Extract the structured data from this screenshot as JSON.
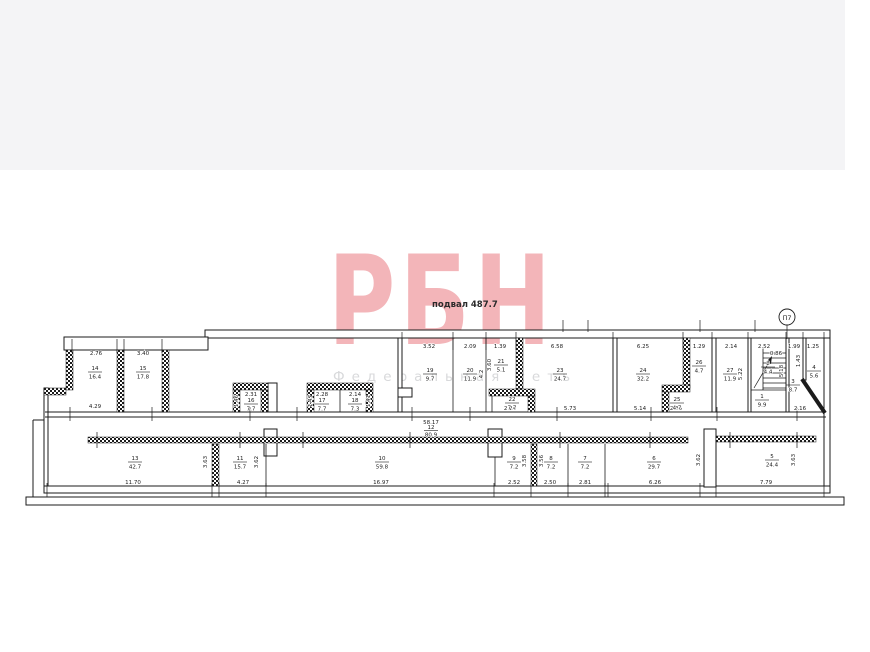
{
  "page": {
    "band_color": "#f4f4f6"
  },
  "watermark": {
    "brand": "РБН",
    "subtitle": "Федеральная сеть",
    "brand_color": "#e24650"
  },
  "plan": {
    "title": "подвал 487.7",
    "section_marker": "П7",
    "rooms": [
      {
        "num": "14",
        "area": "16.4"
      },
      {
        "num": "15",
        "area": "17.8"
      },
      {
        "num": "16",
        "area": "7.7"
      },
      {
        "num": "17",
        "area": "7.7"
      },
      {
        "num": "18",
        "area": "7.3"
      },
      {
        "num": "19",
        "area": "9.7"
      },
      {
        "num": "20",
        "area": "11.9"
      },
      {
        "num": "21",
        "area": "5.1"
      },
      {
        "num": "22",
        "area": "7.7"
      },
      {
        "num": "23",
        "area": "24.7"
      },
      {
        "num": "24",
        "area": "32.2"
      },
      {
        "num": "26",
        "area": "4.7"
      },
      {
        "num": "25",
        "area": "4.7"
      },
      {
        "num": "27",
        "area": "11.9"
      },
      {
        "num": "2",
        "area": "4.4"
      },
      {
        "num": "1",
        "area": "9.9"
      },
      {
        "num": "3",
        "area": "8.7"
      },
      {
        "num": "4",
        "area": "5.6"
      },
      {
        "num": "12",
        "area": "80.9"
      },
      {
        "num": "13",
        "area": "42.7"
      },
      {
        "num": "11",
        "area": "15.7"
      },
      {
        "num": "10",
        "area": "59.8"
      },
      {
        "num": "9",
        "area": "7.2"
      },
      {
        "num": "8",
        "area": "7.2"
      },
      {
        "num": "7",
        "area": "7.2"
      },
      {
        "num": "6",
        "area": "29.7"
      },
      {
        "num": "5",
        "area": "24.4"
      }
    ],
    "dims": [
      "2.76",
      "3.40",
      "4.29",
      "2.31",
      "2.28",
      "2.14",
      "3.52",
      "2.09",
      "1.39",
      "6.58",
      "2.24",
      "5.73",
      "6.25",
      "1.29",
      "2.35",
      "5.14",
      "2.14",
      "2.52",
      "0.86",
      "1.99",
      "1.25",
      "2.16",
      "58.17",
      "11.70",
      "4.27",
      "16.97",
      "2.52",
      "2.50",
      "2.81",
      "6.26",
      "7.79"
    ],
    "vdims": [
      "1.46",
      "1.47",
      "1.41",
      "4.2",
      "3.60",
      "3.63",
      "3.62",
      "3.58",
      "3.56",
      "3.62",
      "3.63",
      "5.18",
      "1.43",
      "5.22"
    ]
  }
}
